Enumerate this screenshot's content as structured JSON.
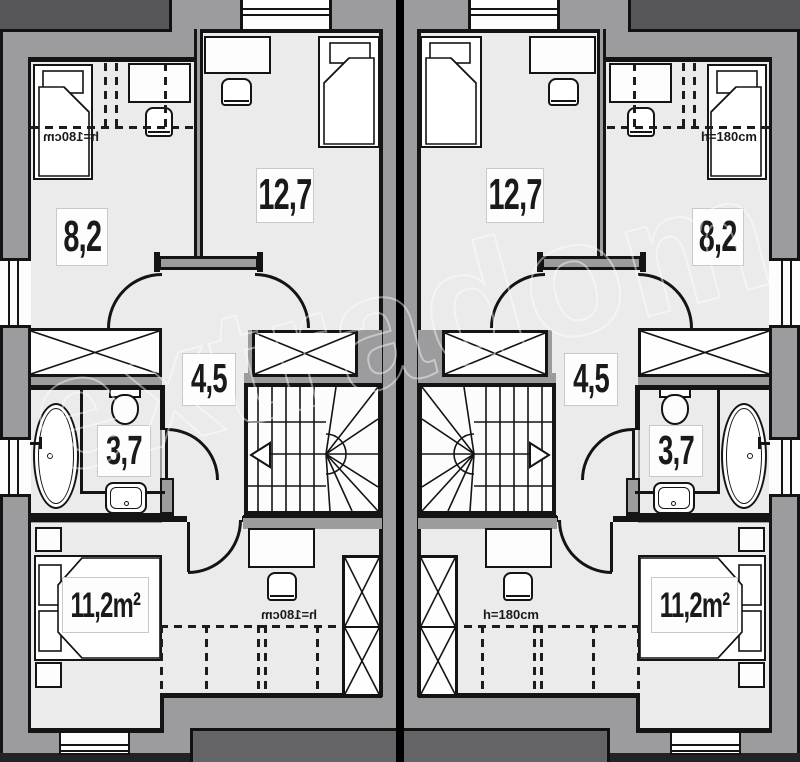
{
  "watermark": "extradom",
  "units": [
    {
      "side": "left",
      "labels": {
        "bedroom_small": "8,2",
        "bedroom_large": "12,7",
        "hallway": "4,5",
        "bathroom": "3,7",
        "bedroom_bottom": "11,2m²"
      },
      "notes": {
        "ceiling_top": "h=180cm",
        "ceiling_bottom": "h=180cm"
      }
    },
    {
      "side": "right",
      "labels": {
        "bedroom_small": "8,2",
        "bedroom_large": "12,7",
        "hallway": "4,5",
        "bathroom": "3,7",
        "bedroom_bottom": "11,2m²"
      },
      "notes": {
        "ceiling_top": "h=180cm",
        "ceiling_bottom": "h=180cm"
      }
    }
  ]
}
